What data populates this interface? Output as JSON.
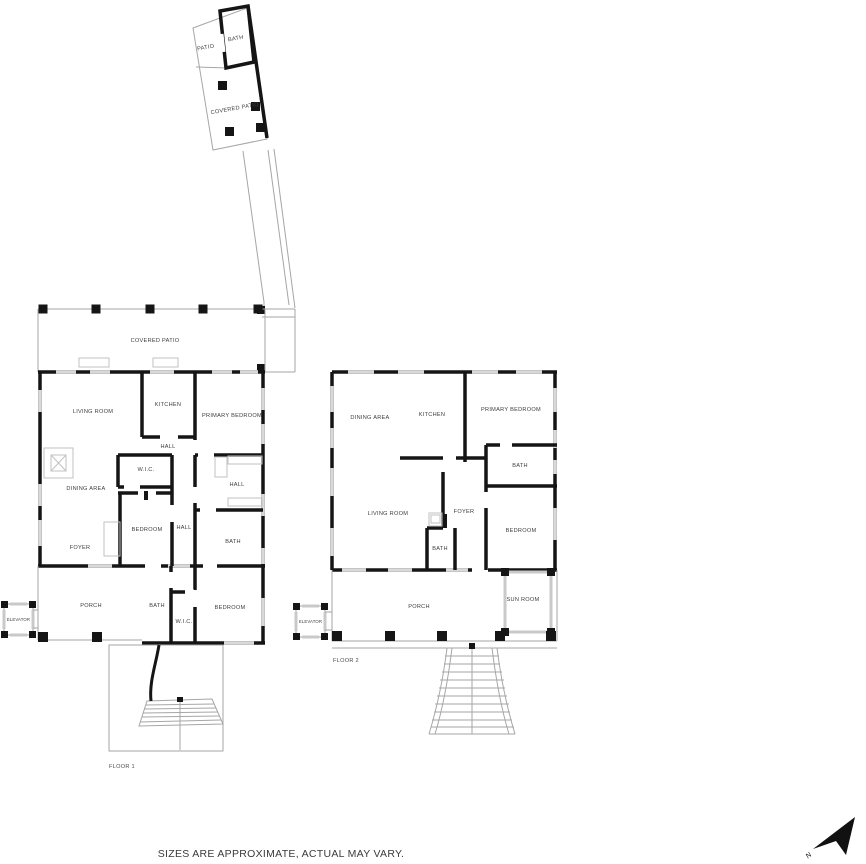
{
  "footer": {
    "disclaimer": "SIZES ARE APPROXIMATE, ACTUAL MAY VARY."
  },
  "compass": {
    "direction_label": "N"
  },
  "palette": {
    "wall": "#151515",
    "thin_line": "#a6a6a6",
    "window": "#d9d9d9",
    "label": "#3d3d3d",
    "background": "#ffffff"
  },
  "detached_structure": {
    "rooms": {
      "patio": "PATIO",
      "bath": "BATH",
      "covered_patio": "COVERED PATIO"
    }
  },
  "floor1": {
    "label": "FLOOR 1",
    "rooms": {
      "covered_patio": "COVERED PATIO",
      "living_room": "LIVING ROOM",
      "kitchen": "KITCHEN",
      "primary_bedroom": "PRIMARY BEDROOM",
      "hall_top": "HALL",
      "wic_top": "W.I.C.",
      "dining_area": "DINING AREA",
      "hall_right": "HALL",
      "bedroom_mid": "BEDROOM",
      "hall_center": "HALL",
      "bath_mid": "BATH",
      "foyer": "FOYER",
      "porch": "PORCH",
      "bath_lower": "BATH",
      "wic_lower": "W.I.C.",
      "bedroom_lower": "BEDROOM",
      "elevator": "ELEVATOR"
    }
  },
  "floor2": {
    "label": "FLOOR 2",
    "rooms": {
      "dining_area": "DINING AREA",
      "kitchen": "KITCHEN",
      "primary_bedroom": "PRIMARY BEDROOM",
      "bath_upper": "BATH",
      "living_room": "LIVING ROOM",
      "foyer": "FOYER",
      "bath_lower": "BATH",
      "bedroom": "BEDROOM",
      "sun_room": "SUN ROOM",
      "porch": "PORCH",
      "elevator": "ELEVATOR"
    }
  }
}
